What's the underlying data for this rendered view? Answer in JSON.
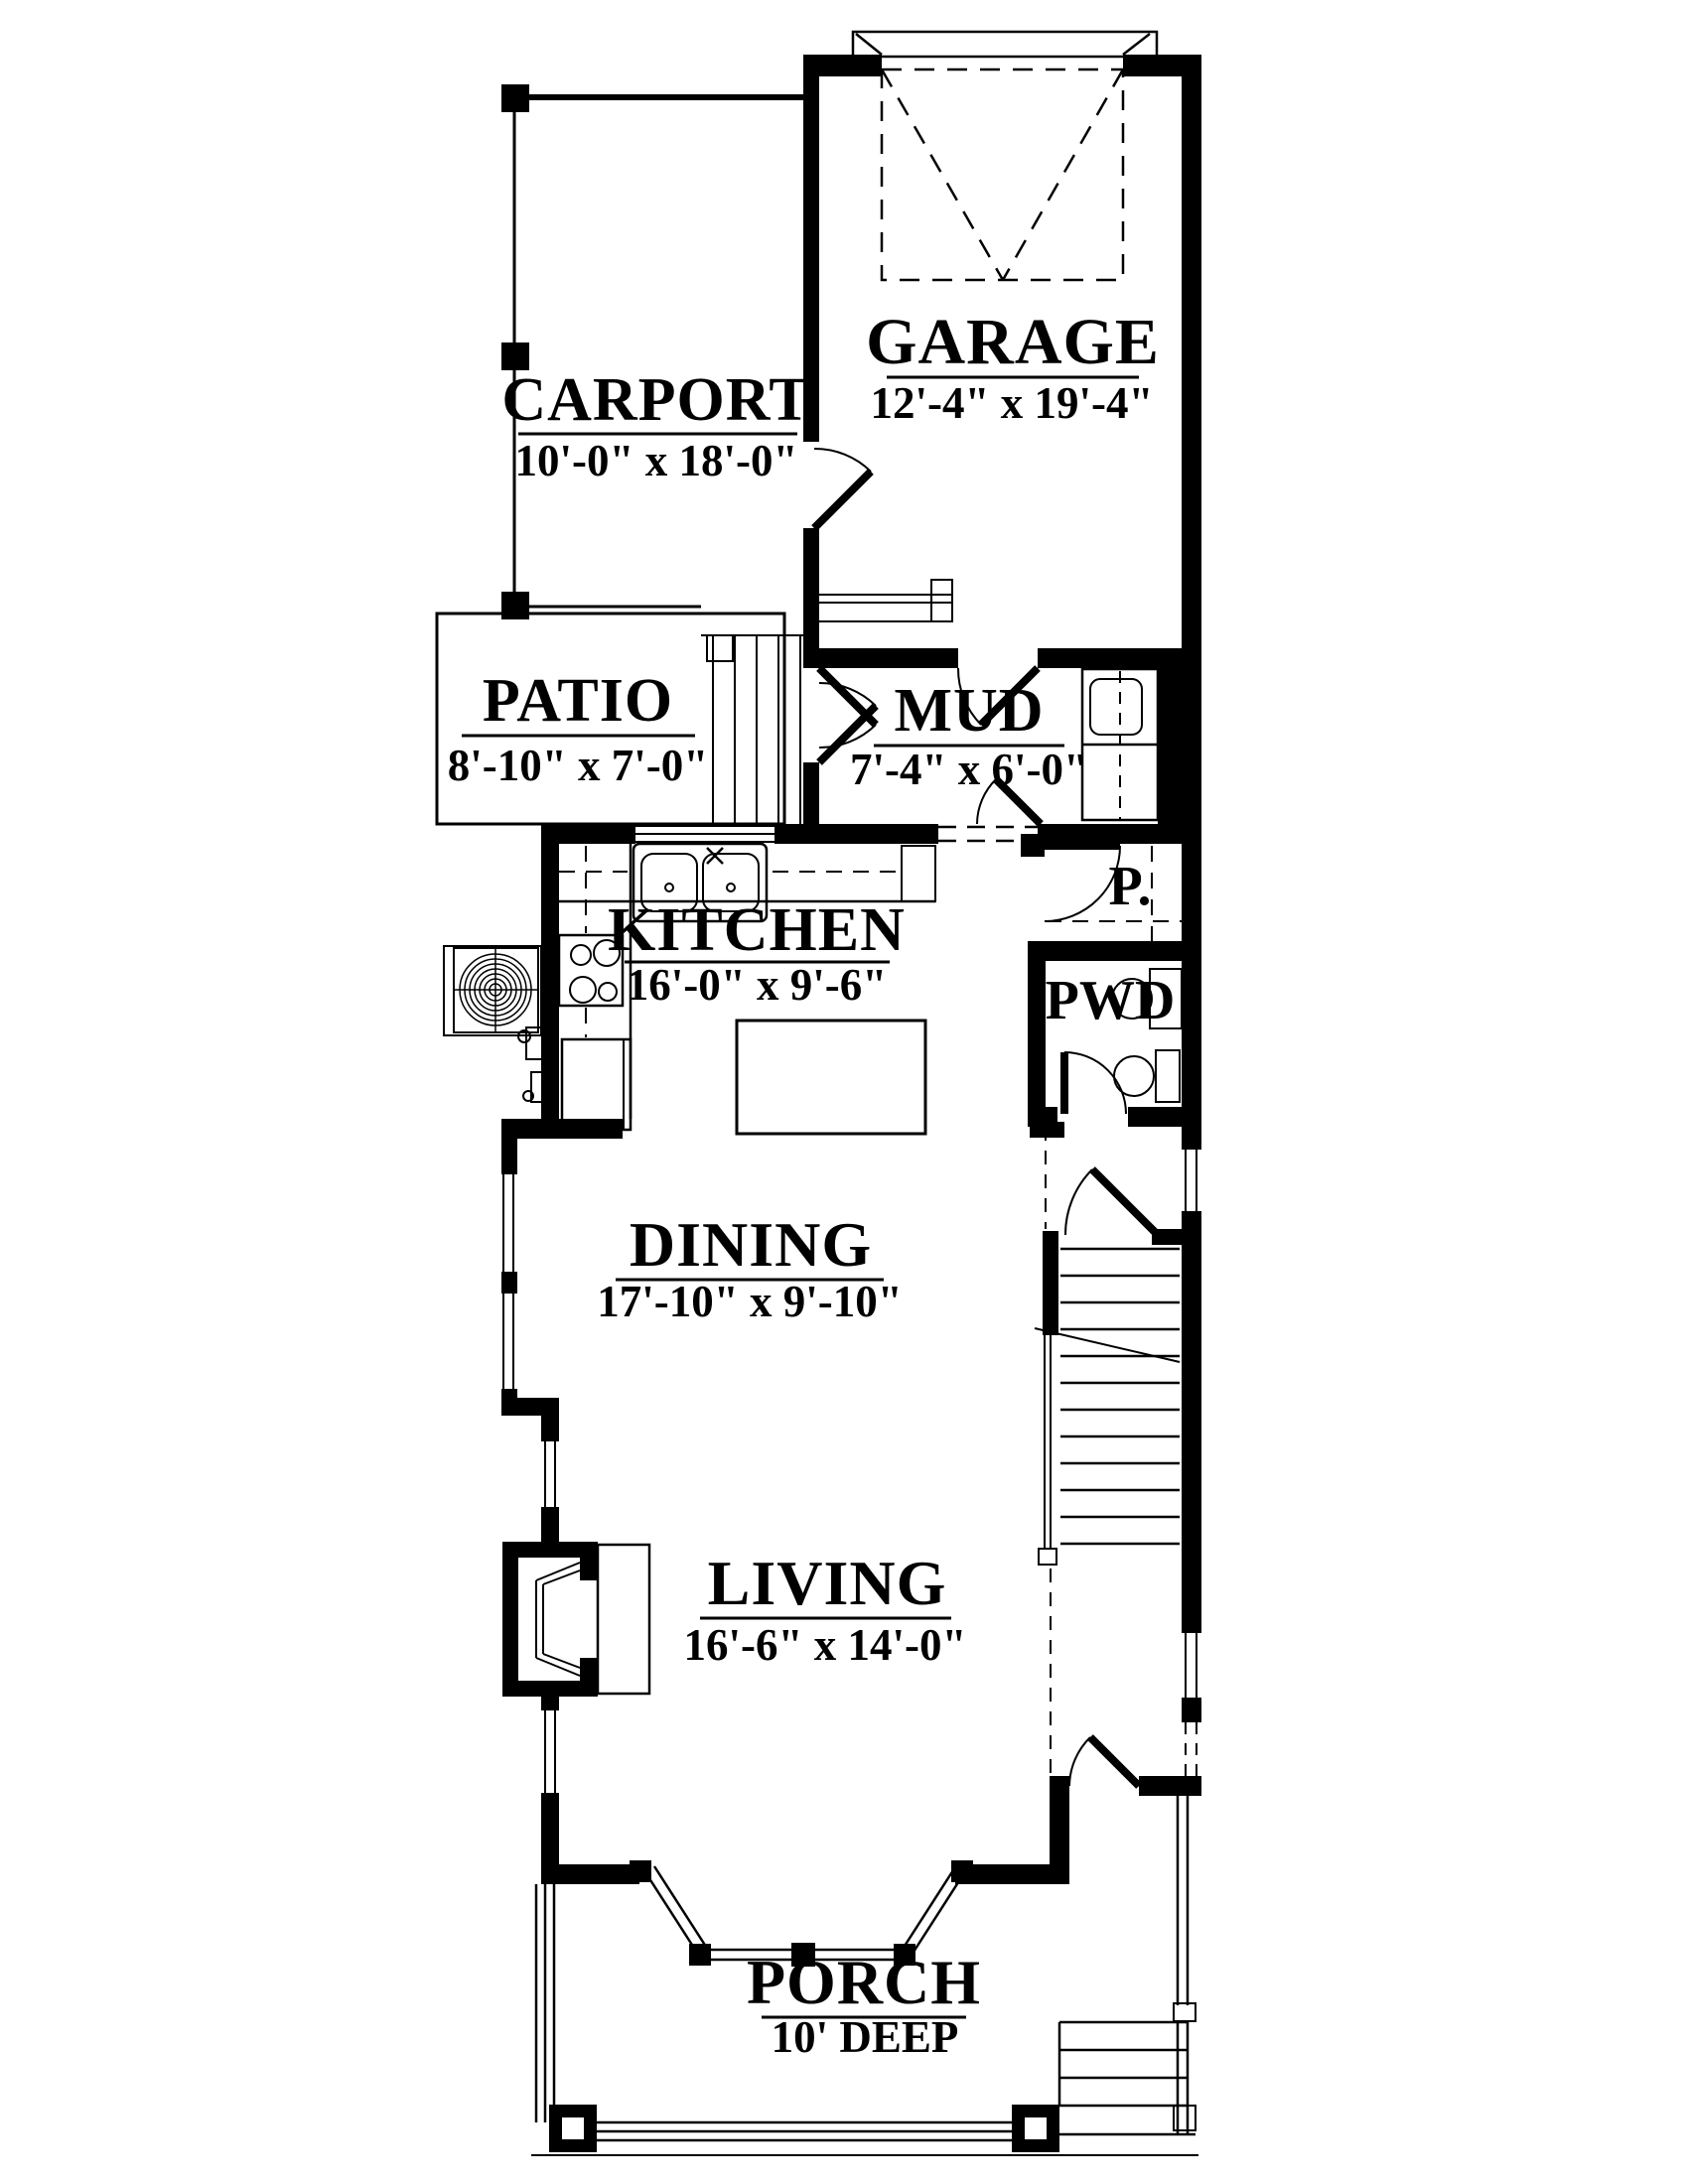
{
  "drawing": {
    "type": "first-floor-plan",
    "colors": {
      "line": "#000000",
      "background": "#ffffff"
    }
  },
  "rooms": [
    {
      "id": "carport",
      "name": "CARPORT",
      "dims": "10'-0\" x 18'-0\""
    },
    {
      "id": "garage",
      "name": "GARAGE",
      "dims": "12'-4\" x 19'-4\""
    },
    {
      "id": "patio",
      "name": "PATIO",
      "dims": "8'-10\" x 7'-0\""
    },
    {
      "id": "mud",
      "name": "MUD",
      "dims": "7'-4\" x 6'-0\""
    },
    {
      "id": "kitchen",
      "name": "KITCHEN",
      "dims": "16'-0\" x 9'-6\""
    },
    {
      "id": "pantry",
      "name": "P."
    },
    {
      "id": "powder",
      "name": "PWD"
    },
    {
      "id": "dining",
      "name": "DINING",
      "dims": "17'-10\" x 9'-10\""
    },
    {
      "id": "living",
      "name": "LIVING",
      "dims": "16'-6\" x 14'-0\""
    },
    {
      "id": "porch",
      "name": "PORCH",
      "dims": "10' DEEP"
    }
  ],
  "fixtures": [
    "garage-overhead-door",
    "kitchen-sink",
    "range-cooktop",
    "refrigerator",
    "kitchen-island",
    "ac-condenser-fan",
    "washer-dryer-stack",
    "powder-toilet",
    "powder-vanity-sink",
    "fireplace-hearth",
    "staircase-up",
    "patio-steps",
    "porch-columns",
    "porch-side-steps",
    "bay-window",
    "french-doors",
    "front-door"
  ]
}
